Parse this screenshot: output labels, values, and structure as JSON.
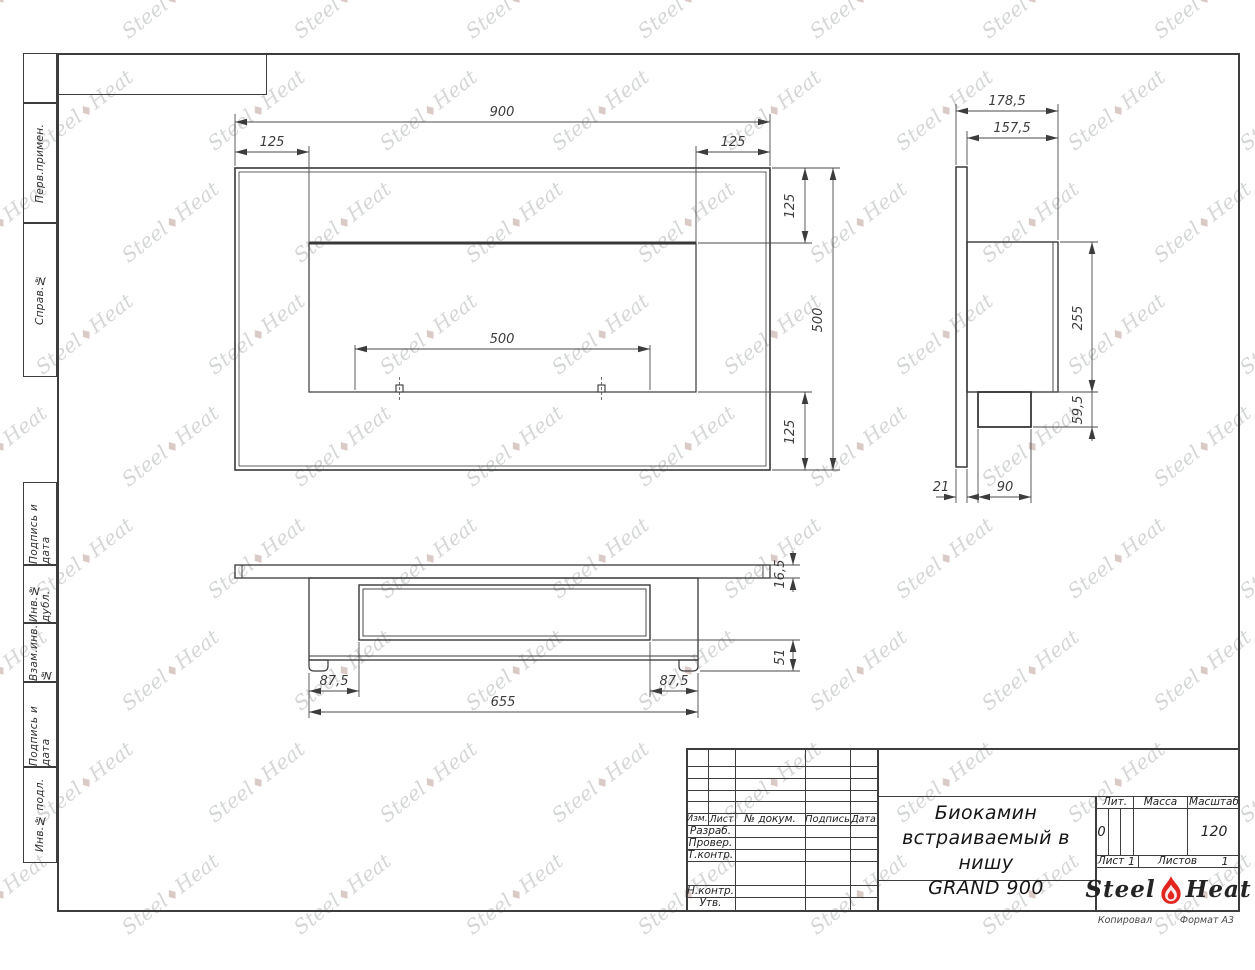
{
  "left_margin": {
    "cells": [
      "Перв.примен.",
      "Справ.№",
      "Подпись и дата",
      "Инв.№ дубл.",
      "Взам.инв.№",
      "Подпись и дата",
      "Инв.№ подл."
    ]
  },
  "dims": {
    "front_width": "900",
    "front_left": "125",
    "front_right": "125",
    "front_top": "125",
    "front_height": "500",
    "front_opening": "500",
    "front_bottom": "125",
    "side_depth": "178,5",
    "side_inner_depth": "157,5",
    "side_body_height": "255",
    "side_lip_height": "59,5",
    "side_flange": "21",
    "side_lip_depth": "90",
    "bottom_inset_left": "87,5",
    "bottom_inset_right": "87,5",
    "bottom_length": "655",
    "bottom_flange": "16,5",
    "bottom_foot": "51"
  },
  "title_block": {
    "change_header": [
      "Изм.",
      "Лист",
      "№ докум.",
      "Подпись",
      "Дата"
    ],
    "rows": [
      "Разраб.",
      "Провер.",
      "Т.контр.",
      "Н.контр.",
      "Утв."
    ],
    "product_title": [
      "Биокамин",
      "встраиваемый в нишу",
      "GRAND 900"
    ],
    "lit_label": "Лит.",
    "lit_value": "0",
    "mass_label": "Масса",
    "scale_label": "Масштаб",
    "scale_value": "120",
    "sheet_label": "Лист",
    "sheet_value": "1",
    "sheets_label": "Листов",
    "sheets_value": "1",
    "brand": {
      "left": "Steel",
      "right": "Heat"
    },
    "below": {
      "copied": "Копировал",
      "format": "Формат А3"
    }
  },
  "watermark": {
    "left": "Steel",
    "right": "Heat",
    "flame_glyph": "♦"
  },
  "colors": {
    "line": "#3d3d3d",
    "flame_red": "#e2261f"
  }
}
